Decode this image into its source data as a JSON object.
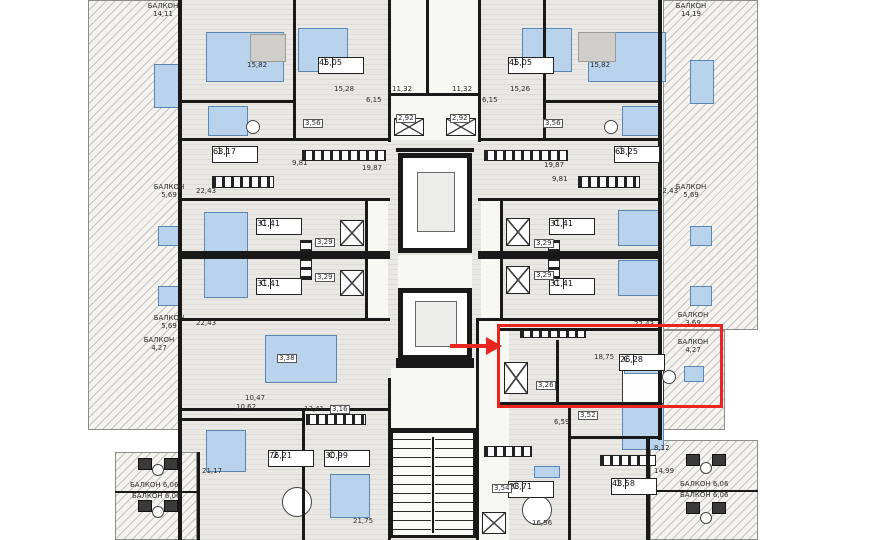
{
  "plan": {
    "kind": "residential-floor-plan",
    "colors": {
      "wall": "#191919",
      "floor": "#eae8e4",
      "hatch_base": "#f4f3f0",
      "furniture_blue": "#b9d3ec",
      "highlight": "#e8251f"
    },
    "highlight": {
      "unit_type": "С",
      "unit_area": "26,28"
    },
    "units": [
      {
        "type": "1",
        "area": "45,05",
        "x": 318,
        "y": 57
      },
      {
        "type": "1",
        "area": "45,05",
        "x": 508,
        "y": 57
      },
      {
        "type": "1",
        "area": "63,17",
        "x": 212,
        "y": 146
      },
      {
        "type": "1",
        "area": "63,25",
        "x": 614,
        "y": 146
      },
      {
        "type": "С",
        "area": "31,41",
        "x": 256,
        "y": 218
      },
      {
        "type": "С",
        "area": "31,41",
        "x": 256,
        "y": 278
      },
      {
        "type": "С",
        "area": "31,41",
        "x": 549,
        "y": 218
      },
      {
        "type": "С",
        "area": "31,41",
        "x": 549,
        "y": 278
      },
      {
        "type": "С",
        "area": "26,28",
        "x": 619,
        "y": 354,
        "hl": true
      },
      {
        "type": "2",
        "area": "76,21",
        "x": 268,
        "y": 450
      },
      {
        "type": "С",
        "area": "30,99",
        "x": 324,
        "y": 450
      },
      {
        "type": "С",
        "area": "28,71",
        "x": 508,
        "y": 481
      },
      {
        "type": "1",
        "area": "43,58",
        "x": 611,
        "y": 478
      }
    ],
    "balconies": [
      {
        "label": "БАЛКОН",
        "value": "14,11",
        "x": 140,
        "y": 2,
        "mode": "stack"
      },
      {
        "label": "БАЛКОН",
        "value": "14,19",
        "x": 668,
        "y": 2,
        "mode": "stack"
      },
      {
        "label": "БАЛКОН",
        "value": "5,69",
        "x": 146,
        "y": 183,
        "mode": "stack"
      },
      {
        "label": "БАЛКОН",
        "value": "5,69",
        "x": 668,
        "y": 183,
        "mode": "stack"
      },
      {
        "label": "БАЛКОН",
        "value": "5,69",
        "x": 146,
        "y": 314,
        "mode": "stack"
      },
      {
        "label": "БАЛКОН",
        "value": "3,69",
        "x": 670,
        "y": 311,
        "mode": "stack"
      },
      {
        "label": "БАЛКОН",
        "value": "4,27",
        "x": 136,
        "y": 336,
        "mode": "stack"
      },
      {
        "label": "БАЛКОН",
        "value": "4,27",
        "x": 670,
        "y": 338,
        "mode": "stack"
      },
      {
        "label": "БАЛКОН",
        "value": "6,06",
        "x": 130,
        "y": 481,
        "mode": "inline"
      },
      {
        "label": "БАЛКОН",
        "value": "6,06",
        "x": 132,
        "y": 492,
        "mode": "inline"
      },
      {
        "label": "БАЛКОН",
        "value": "6,06",
        "x": 680,
        "y": 480,
        "mode": "inline"
      },
      {
        "label": "БАЛКОН",
        "value": "6,06",
        "x": 680,
        "y": 491,
        "mode": "inline"
      }
    ],
    "measurements": [
      {
        "value": "15,82",
        "x": 247,
        "y": 62
      },
      {
        "value": "15,82",
        "x": 590,
        "y": 62
      },
      {
        "value": "15,28",
        "x": 334,
        "y": 86
      },
      {
        "value": "15,26",
        "x": 510,
        "y": 86
      },
      {
        "value": "6,15",
        "x": 366,
        "y": 97
      },
      {
        "value": "6,15",
        "x": 482,
        "y": 97
      },
      {
        "value": "11,32",
        "x": 392,
        "y": 86
      },
      {
        "value": "11,32",
        "x": 452,
        "y": 86
      },
      {
        "value": "2,92",
        "x": 396,
        "y": 114,
        "boxed": true
      },
      {
        "value": "2,92",
        "x": 450,
        "y": 114,
        "boxed": true
      },
      {
        "value": "3,56",
        "x": 303,
        "y": 119,
        "boxed": true
      },
      {
        "value": "3,56",
        "x": 543,
        "y": 119,
        "boxed": true
      },
      {
        "value": "9,81",
        "x": 292,
        "y": 160
      },
      {
        "value": "9,81",
        "x": 552,
        "y": 176
      },
      {
        "value": "19,87",
        "x": 362,
        "y": 165
      },
      {
        "value": "19,87",
        "x": 544,
        "y": 162
      },
      {
        "value": "22,43",
        "x": 196,
        "y": 188
      },
      {
        "value": "22,43",
        "x": 658,
        "y": 188
      },
      {
        "value": "22,43",
        "x": 196,
        "y": 320
      },
      {
        "value": "22,43",
        "x": 634,
        "y": 321
      },
      {
        "value": "3,29",
        "x": 315,
        "y": 238,
        "boxed": true
      },
      {
        "value": "3,29",
        "x": 315,
        "y": 273,
        "boxed": true
      },
      {
        "value": "3,29",
        "x": 534,
        "y": 239,
        "boxed": true
      },
      {
        "value": "3,29",
        "x": 534,
        "y": 271,
        "boxed": true
      },
      {
        "value": "18,75",
        "x": 594,
        "y": 354
      },
      {
        "value": "3,26",
        "x": 536,
        "y": 381,
        "boxed": true
      },
      {
        "value": "3,38",
        "x": 277,
        "y": 354,
        "boxed": true
      },
      {
        "value": "10,47",
        "x": 245,
        "y": 395
      },
      {
        "value": "10,62",
        "x": 236,
        "y": 404
      },
      {
        "value": "13,41",
        "x": 304,
        "y": 406
      },
      {
        "value": "3,16",
        "x": 330,
        "y": 405,
        "boxed": true
      },
      {
        "value": "21,17",
        "x": 202,
        "y": 468
      },
      {
        "value": "21,75",
        "x": 353,
        "y": 518
      },
      {
        "value": "16,56",
        "x": 532,
        "y": 520
      },
      {
        "value": "3,54",
        "x": 492,
        "y": 484,
        "boxed": true
      },
      {
        "value": "6,59",
        "x": 554,
        "y": 419
      },
      {
        "value": "3,52",
        "x": 578,
        "y": 411,
        "boxed": true
      },
      {
        "value": "8,12",
        "x": 654,
        "y": 445
      },
      {
        "value": "14,99",
        "x": 654,
        "y": 468
      }
    ]
  }
}
